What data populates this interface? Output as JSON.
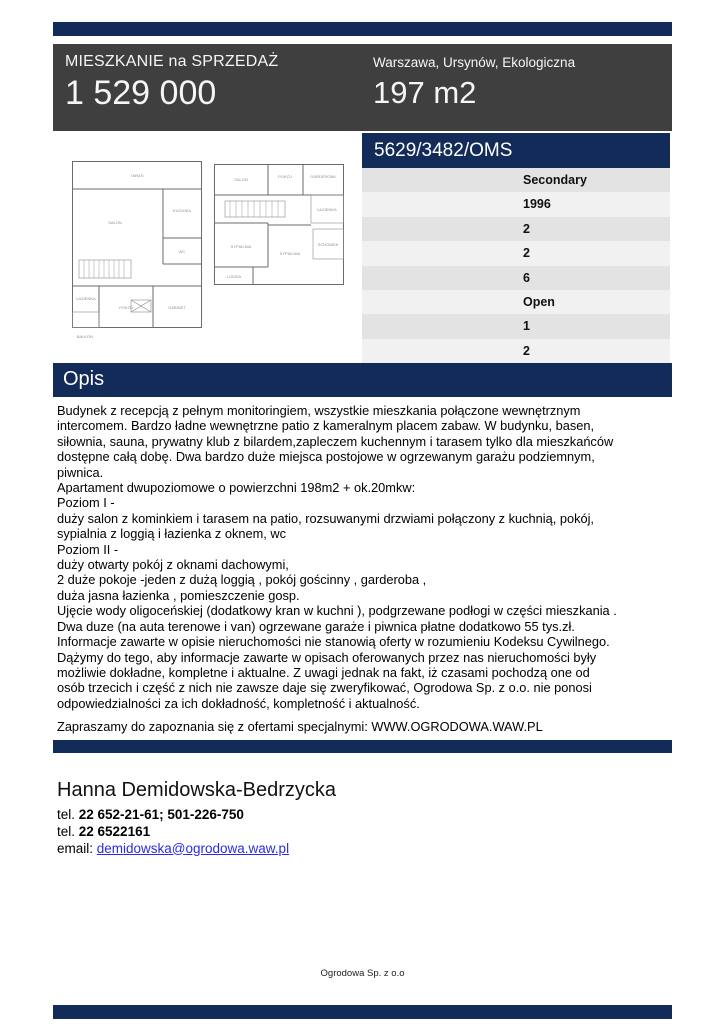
{
  "colors": {
    "navy": "#132B58",
    "header_bg": "#3F3F3F",
    "row_even": "#E3E3E3",
    "row_odd": "#F1F1F1",
    "link_blue": "#2B2BE2"
  },
  "header": {
    "title": "MIESZKANIE na SPRZEDAŻ",
    "price": "1 529 000",
    "location": "Warszawa, Ursynów, Ekologiczna",
    "area": "197 m2"
  },
  "listing_table": {
    "reference": "5629/3482/OMS",
    "rows": [
      "Secondary",
      "1996",
      "2",
      "2",
      "6",
      "Open",
      "1",
      "2"
    ]
  },
  "floorplans": {
    "plan1": {
      "rooms": [
        "TARAS",
        "SALON",
        "KUCHNIA",
        "WC",
        "ŁAZIENKA",
        "POKÓJ",
        "GABINET",
        "BALKON"
      ]
    },
    "plan2": {
      "rooms": [
        "SALON",
        "POKÓJ",
        "GARDEROBA",
        "ŁAZIENKA",
        "SYPIALNIA",
        "SYPIALNIA",
        "SCHOWEK",
        "LODŻIA"
      ]
    }
  },
  "opis": {
    "title": "Opis",
    "lines": [
      "Budynek z recepcją z pełnym monitoringiem, wszystkie mieszkania połączone wewnętrznym",
      "intercomem. Bardzo ładne wewnętrzne patio z kameralnym placem zabaw. W budynku, basen,",
      "siłownia, sauna, prywatny klub z bilardem,zapleczem kuchennym i tarasem tylko dla mieszkańców",
      "dostępne całą dobę. Dwa bardzo duże miejsca postojowe w ogrzewanym garażu podziemnym,",
      "piwnica.",
      "Apartament dwupoziomowe o powierzchni 198m2 + ok.20mkw:",
      "Poziom I -",
      "duży salon z kominkiem i tarasem na patio, rozsuwanymi drzwiami połączony z kuchnią, pokój,",
      "sypialnia z loggią i łazienka z oknem, wc",
      "Poziom II -",
      "duży otwarty pokój z oknami dachowymi,",
      "2 duże pokoje -jeden z dużą loggią , pokój gościnny , garderoba ,",
      "duża jasna łazienka , pomieszczenie gosp.",
      "Ujęcie wody oligoceńskiej (dodatkowy kran w kuchni ), podgrzewane podłogi w części mieszkania .",
      "Dwa duze (na auta terenowe i van) ogrzewane garaże i piwnica płatne dodatkowo 55 tys.zł.",
      "Informacje zawarte w opisie nieruchomości nie stanowią oferty w rozumieniu Kodeksu Cywilnego.",
      "Dążymy do tego, aby informacje zawarte w opisach oferowanych przez nas nieruchomości były",
      "możliwie dokładne, kompletne i aktualne. Z uwagi jednak na fakt, iż czasami pochodzą one od",
      "osób trzecich i część z nich nie zawsze daje się zweryfikować, Ogrodowa Sp. z o.o. nie ponosi",
      "odpowiedzialności za ich dokładność, kompletność i aktualność."
    ],
    "invite": "Zapraszamy do zapoznania się z ofertami specjalnymi: WWW.OGRODOWA.WAW.PL"
  },
  "contact": {
    "name": "Hanna Demidowska-Bedrzycka",
    "tel_label": "tel. ",
    "tel1": "22 652-21-61; 501-226-750",
    "tel2": "22 6522161",
    "email_label": "email: ",
    "email": "demidowska@ogrodowa.waw.pl"
  },
  "footer": {
    "company": "Ogrodowa Sp. z o.o"
  }
}
